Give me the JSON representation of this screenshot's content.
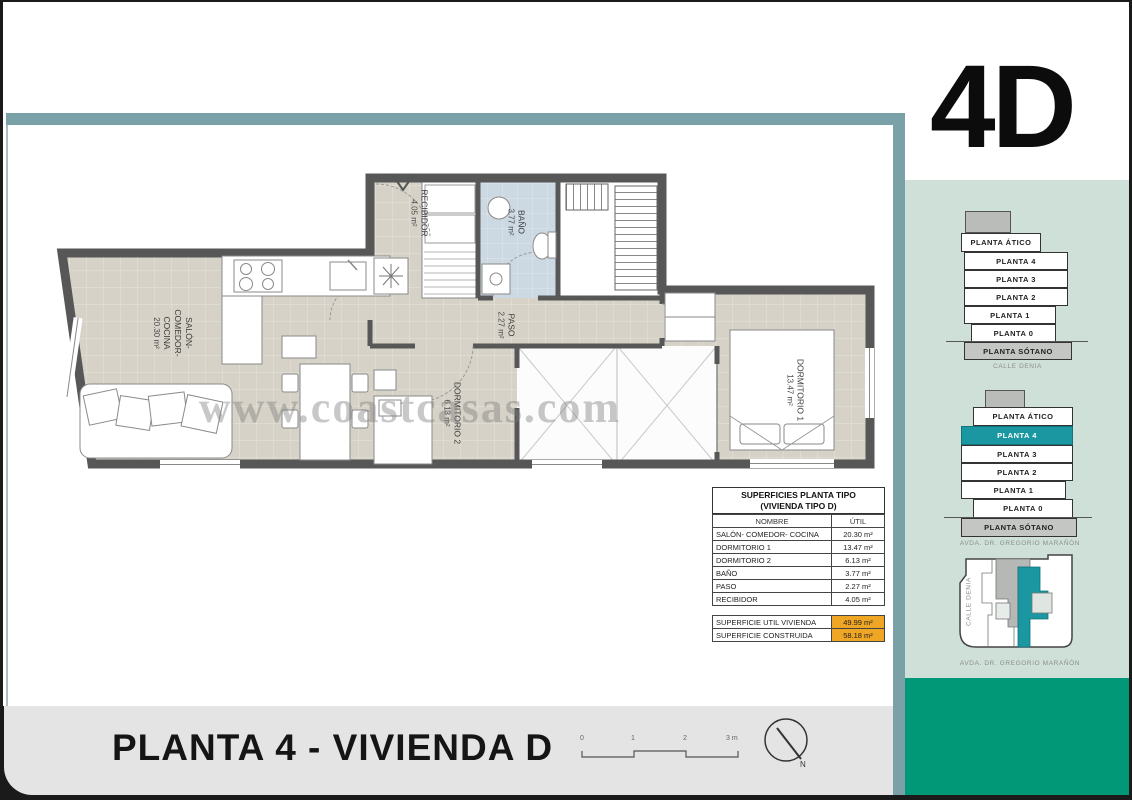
{
  "logo": "4D",
  "watermark": "www.coastcasas.com",
  "footer": {
    "title": "PLANTA 4 - VIVIENDA D",
    "north_label": "N",
    "scale_labels": [
      "0",
      "1",
      "2",
      "3 m"
    ]
  },
  "rooms": {
    "salon": {
      "l1": "SALÓN-",
      "l2": "COMEDOR-",
      "l3": "COCINA",
      "area": "20.30 m²"
    },
    "recibidor": {
      "name": "RECIBIDOR",
      "area": "4.05 m²"
    },
    "bano": {
      "name": "BAÑO",
      "area": "3.77 m²"
    },
    "paso": {
      "name": "PASO",
      "area": "2.27 m²"
    },
    "dorm2": {
      "name": "DORMITORIO 2",
      "area": "6.13 m²"
    },
    "dorm1": {
      "name": "DORMITORIO 1",
      "area": "13.47 m²"
    }
  },
  "table": {
    "title_line1": "SUPERFICIES PLANTA TIPO",
    "title_line2": "(VIVIENDA TIPO D)",
    "col_name": "NOMBRE",
    "col_util": "ÚTIL",
    "rows": [
      {
        "name": "SALÓN- COMEDOR- COCINA",
        "util": "20.30 m²"
      },
      {
        "name": "DORMITORIO 1",
        "util": "13.47 m²"
      },
      {
        "name": "DORMITORIO 2",
        "util": "6.13 m²"
      },
      {
        "name": "BAÑO",
        "util": "3.77 m²"
      },
      {
        "name": "PASO",
        "util": "2.27 m²"
      },
      {
        "name": "RECIBIDOR",
        "util": "4.05 m²"
      }
    ],
    "summary": [
      {
        "name": "SUPERFICIE UTIL VIVIENDA",
        "value": "49.99 m²"
      },
      {
        "name": "SUPERFICIE CONSTRUIDA",
        "value": "58.18 m²"
      }
    ]
  },
  "stacks": {
    "first": {
      "levels": [
        "PLANTA ÁTICO",
        "PLANTA 4",
        "PLANTA 3",
        "PLANTA 2",
        "PLANTA 1",
        "PLANTA 0",
        "PLANTA SÓTANO"
      ],
      "caption": "CALLE DENIA"
    },
    "second": {
      "levels": [
        "PLANTA ÁTICO",
        "PLANTA 4",
        "PLANTA 3",
        "PLANTA 2",
        "PLANTA 1",
        "PLANTA 0",
        "PLANTA SÓTANO"
      ],
      "highlight": "PLANTA 4",
      "caption": "AVDA. DR. GREGORIO MARAÑÓN"
    }
  },
  "siteplan": {
    "left_caption": "CALLE DENIA",
    "bottom_caption": "AVDA. DR. GREGORIO MARAÑÓN"
  },
  "colors": {
    "frame_teal": "#7aa1a7",
    "sidebar_green": "#cfe0d8",
    "brand_green": "#009877",
    "highlight_teal": "#1a97a0",
    "summary_orange": "#f0a625",
    "bath_blue": "#ccd9e3",
    "floor_beige": "#d6d2c7"
  }
}
